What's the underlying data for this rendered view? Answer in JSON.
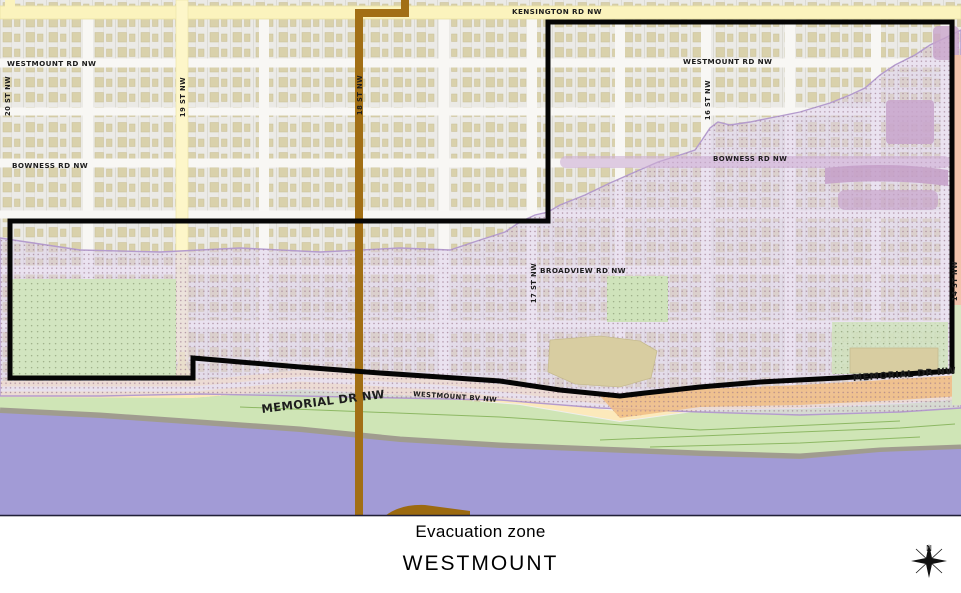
{
  "map": {
    "streets": {
      "kensington": "KENSINGTON RD NW",
      "westmount_rd_left": "WESTMOUNT RD NW",
      "westmount_rd_right": "WESTMOUNT RD NW",
      "bowness_left": "BOWNESS RD NW",
      "bowness_right": "BOWNESS RD NW",
      "broadview": "BROADVIEW RD NW",
      "westmount_bv": "WESTMOUNT BV NW",
      "memorial_left": "MEMORIAL DR NW",
      "memorial_right": "MEMORIAL DR NW",
      "st20": "20 ST NW",
      "st19": "19 ST NW",
      "st18": "18 ST NW",
      "st17": "17 ST NW",
      "st16": "16 ST NW",
      "st14": "14 ST NW"
    },
    "compass": {
      "north_label": "N"
    },
    "colors": {
      "flood_overlay": "#dcd0eb",
      "flood_dots": "#9c7a8f",
      "river": "#a29bd6",
      "park": "#d2e5c0",
      "riverbank_green": "#cfe5b6",
      "road_yellow": "#fbf3bd",
      "road_peach": "#fce9bb",
      "flooded_road_orange": "#f0bc82",
      "route_brown": "#a26f15",
      "boundary_black": "#000000",
      "building_tan": "#d9d1ab",
      "flooded_building_mauve": "#c8a4cb"
    }
  },
  "caption": {
    "zone_label": "Evacuation zone",
    "zone_name": "WESTMOUNT"
  }
}
